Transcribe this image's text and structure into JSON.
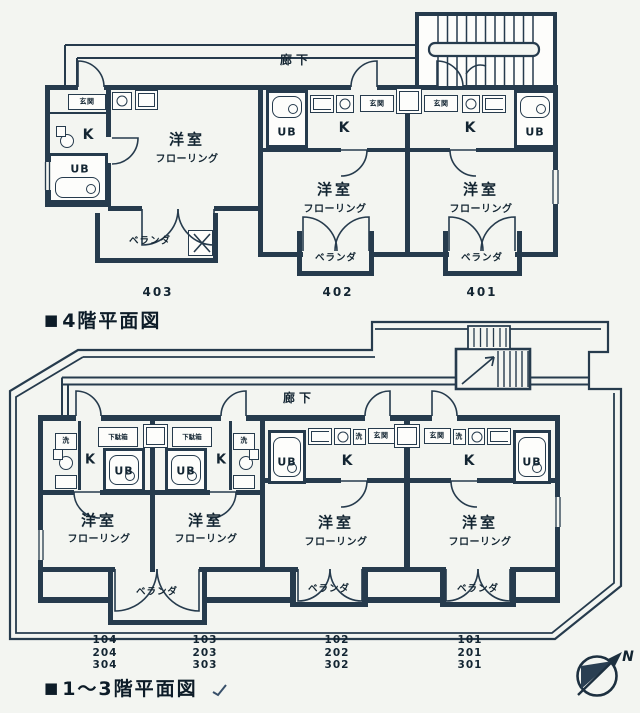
{
  "colors": {
    "ink": "#263b4d",
    "paper": "#f3f5f1"
  },
  "floor4": {
    "caption_bullet": "■",
    "caption": "4階平面図",
    "corridor_label": "廊下",
    "units": {
      "u403": {
        "number": "403",
        "entrance": "玄関",
        "kitchen": "K",
        "bath": "UB",
        "room": "洋室",
        "floor_type": "フローリング",
        "veranda": "ベランダ"
      },
      "u402": {
        "number": "402",
        "entrance": "玄関",
        "kitchen": "K",
        "bath": "UB",
        "room": "洋室",
        "floor_type": "フローリング",
        "veranda": "ベランダ"
      },
      "u401": {
        "number": "401",
        "entrance": "玄関",
        "kitchen": "K",
        "bath": "UB",
        "room": "洋室",
        "floor_type": "フローリング",
        "veranda": "ベランダ"
      }
    }
  },
  "floor13": {
    "caption_bullet": "■",
    "caption": "1〜3階平面図",
    "corridor_label": "廊下",
    "shared_veranda": "ベランダ",
    "units": {
      "u104": {
        "numbers": [
          "104",
          "204",
          "304"
        ],
        "laundry": "洗",
        "shoe": "下駄箱",
        "kitchen": "K",
        "bath": "UB",
        "room": "洋室",
        "floor_type": "フローリング"
      },
      "u103": {
        "numbers": [
          "103",
          "203",
          "303"
        ],
        "laundry": "洗",
        "shoe": "下駄箱",
        "kitchen": "K",
        "bath": "UB",
        "room": "洋室",
        "floor_type": "フローリング"
      },
      "u102": {
        "numbers": [
          "102",
          "202",
          "302"
        ],
        "entrance": "玄関",
        "laundry": "洗",
        "kitchen": "K",
        "bath": "UB",
        "room": "洋室",
        "floor_type": "フローリング",
        "veranda": "ベランダ"
      },
      "u101": {
        "numbers": [
          "101",
          "201",
          "301"
        ],
        "entrance": "玄関",
        "laundry": "洗",
        "kitchen": "K",
        "bath": "UB",
        "room": "洋室",
        "floor_type": "フローリング",
        "veranda": "ベランダ"
      }
    }
  },
  "compass": {
    "label": "N"
  }
}
